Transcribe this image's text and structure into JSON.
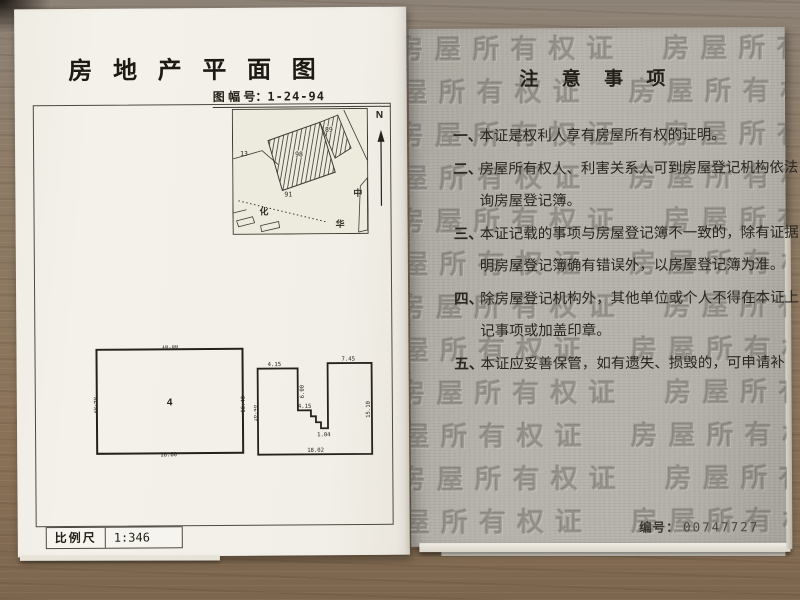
{
  "left_page": {
    "title": "房 地 产 平 面 图",
    "sheet_label": "图 幅 号：",
    "sheet_number": "1-24-94",
    "map": {
      "north_label": "N",
      "parcel_number_left": "13",
      "building_number_main": "98",
      "building_number_top": "89",
      "road_number": "91",
      "street_char_1": "化",
      "street_char_2": "中",
      "street_char_3": "华"
    },
    "plan_left": {
      "unit_number": "4",
      "dim_top": "18.80",
      "dim_bottom": "18.80",
      "dim_left": "16.40",
      "dim_right": "16.40"
    },
    "plan_right": {
      "dim_top_left": "4.15",
      "dim_top_right": "7.45",
      "dim_inner_vertical": "6.00",
      "dim_inner_horizontal": "4.15",
      "dim_step": "1.04",
      "dim_bottom": "18.02",
      "dim_outer_left": "16.40",
      "dim_outer_right": "15.10"
    },
    "scale_label": "比例尺",
    "scale_value": "1:346"
  },
  "right_page": {
    "watermark_text": "房屋所有权证",
    "title": "注 意 事 项",
    "notes": [
      {
        "num": "一、",
        "lines": [
          "本证是权利人享有房屋所有权的证明。"
        ]
      },
      {
        "num": "二、",
        "lines": [
          "房屋所有权人、利害关系人可到房屋登记机构依法",
          "询房屋登记簿。"
        ]
      },
      {
        "num": "三、",
        "lines": [
          "本证记载的事项与房屋登记簿不一致的，除有证据",
          "明房屋登记簿确有错误外，以房屋登记簿为准。"
        ]
      },
      {
        "num": "四、",
        "lines": [
          "除房屋登记机构外，其他单位或个人不得在本证上",
          "记事项或加盖印章。"
        ]
      },
      {
        "num": "五、",
        "lines": [
          "本证应妥善保管，如有遗失、损毁的，可申请补"
        ]
      }
    ],
    "serial_label": "编号：",
    "serial_number": "00747727"
  }
}
